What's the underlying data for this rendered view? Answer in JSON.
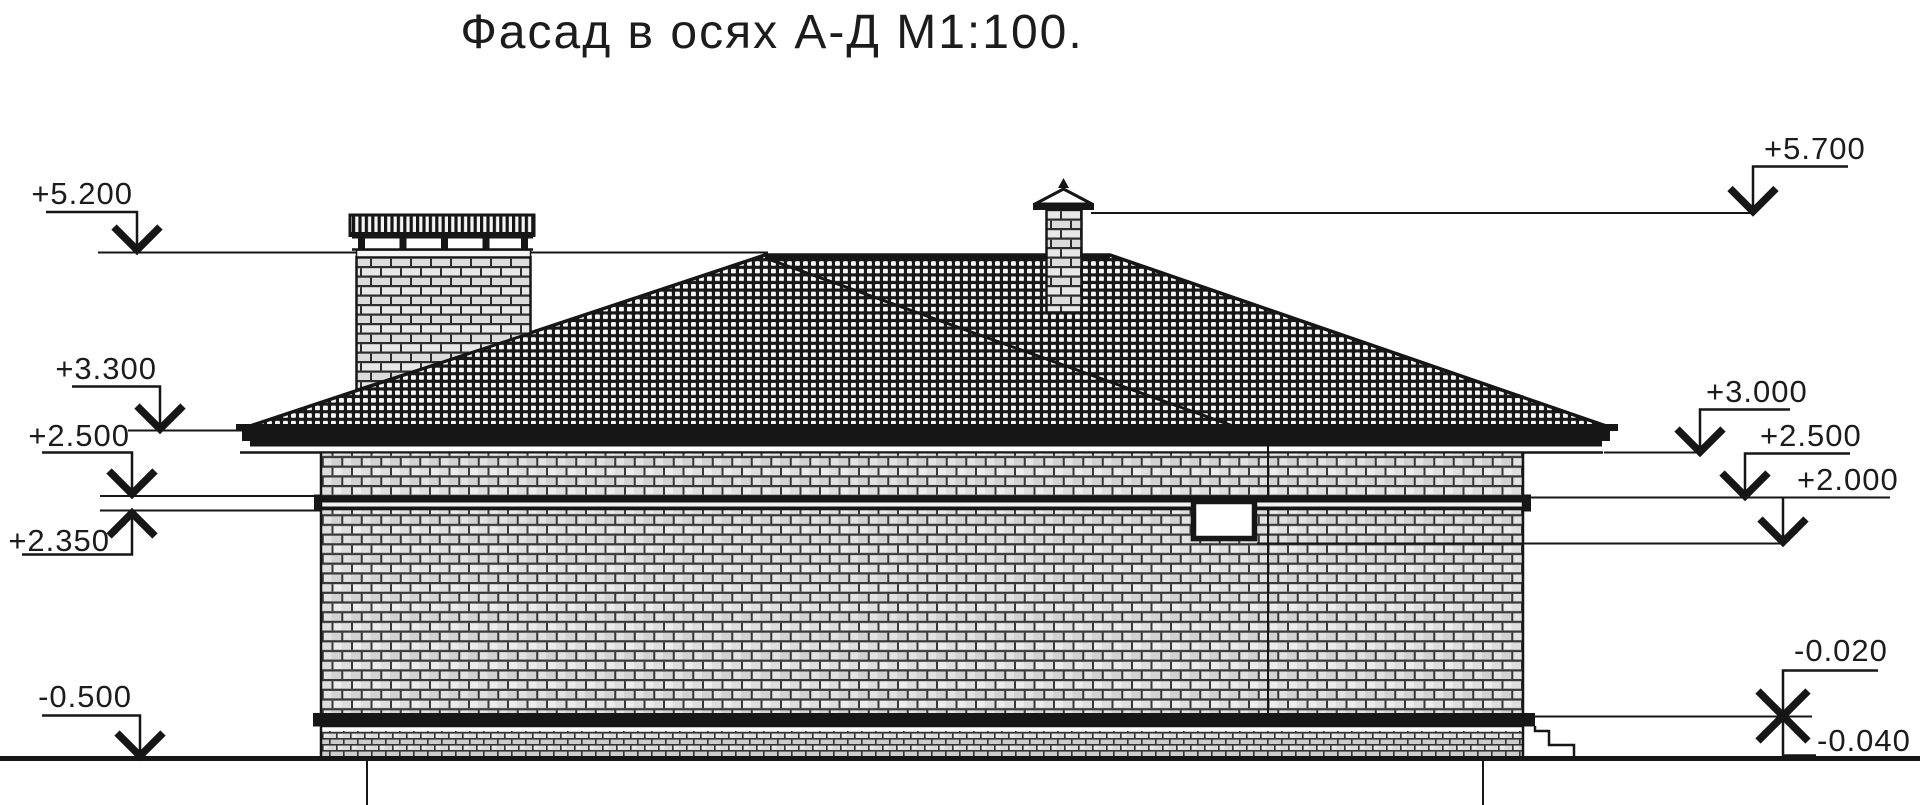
{
  "title": "Фасад в осях А-Д М1:100.",
  "drawing": {
    "kind": "house-facade-elevation",
    "axes_range": "А-Д",
    "scale": "М1:100",
    "ink_color": "#161616",
    "paper_color": "#ffffff"
  },
  "marks_left": [
    {
      "name": "ridge-level",
      "label": "+5.200"
    },
    {
      "name": "eave-top-level",
      "label": "+3.300"
    },
    {
      "name": "belt-top-level",
      "label": "+2.500"
    },
    {
      "name": "belt-bottom-level",
      "label": "+2.350"
    },
    {
      "name": "ground-level",
      "label": "-0.500"
    }
  ],
  "marks_right": [
    {
      "name": "chimney-top-level",
      "label": "+5.700"
    },
    {
      "name": "wall-top-level",
      "label": "+3.000"
    },
    {
      "name": "window-top-level",
      "label": "+2.500"
    },
    {
      "name": "window-sill-level",
      "label": "+2.000"
    },
    {
      "name": "plinth-top-level",
      "label": "-0.020"
    },
    {
      "name": "blind-area-level",
      "label": "-0.040"
    }
  ]
}
